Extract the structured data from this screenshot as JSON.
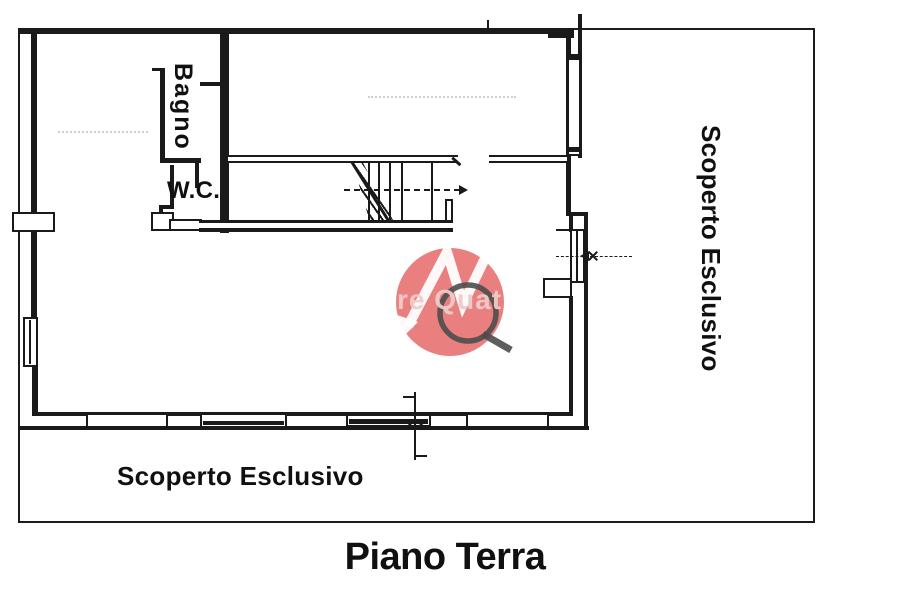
{
  "page": {
    "paper_color": "#ffffff",
    "ink_color": "#1a1a1a"
  },
  "plan": {
    "title": "Piano Terra",
    "room_labels": {
      "bagno": "Bagno",
      "wc": "W.C."
    },
    "area_labels": {
      "right_vertical": "Scoperto Esclusivo",
      "bottom": "Scoperto Esclusivo"
    }
  },
  "watermark": {
    "visible_text": "re Quat",
    "circle_color": "#e4605f",
    "monogram_color": "#4d4d4d",
    "arrow_color": "#ffffff",
    "text_color": "#edccca"
  }
}
